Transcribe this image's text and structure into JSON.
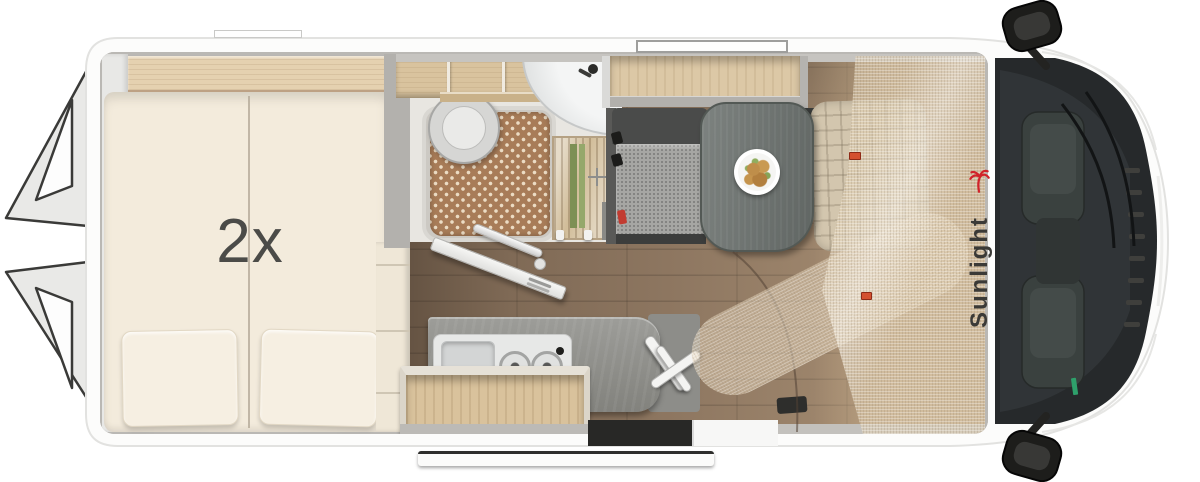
{
  "page": {
    "background": "#ffffff",
    "description": "Top-down 3D floor plan rendering of a Sunlight camper van with rear twin bed, bathroom, kitchen, dinette and cab"
  },
  "labels": {
    "bed_count": "2x",
    "brand": "Sunlight"
  },
  "colors": {
    "brand_red": "#d1232a",
    "logo_text": "#3b3a37",
    "bed_label": "#4b4b48",
    "body_white": "#fbfbfa",
    "bed_cream": "#f3ebdc",
    "wood_light": "#ddc7a3",
    "floor_brown": "#8d7660",
    "counter_slate": "#92928e",
    "cab_glass": "#26292b",
    "shower_mat": "#a87c58",
    "mesh_beige": "#e3d3b7",
    "accent_tag": "#d4502f",
    "extinguisher_red": "#bf3a2e"
  },
  "icons": {
    "palm": "palm-tree-icon",
    "plate": "food-plate-icon",
    "burners": "stove-burner-icon",
    "mirror": "side-mirror-icon"
  }
}
